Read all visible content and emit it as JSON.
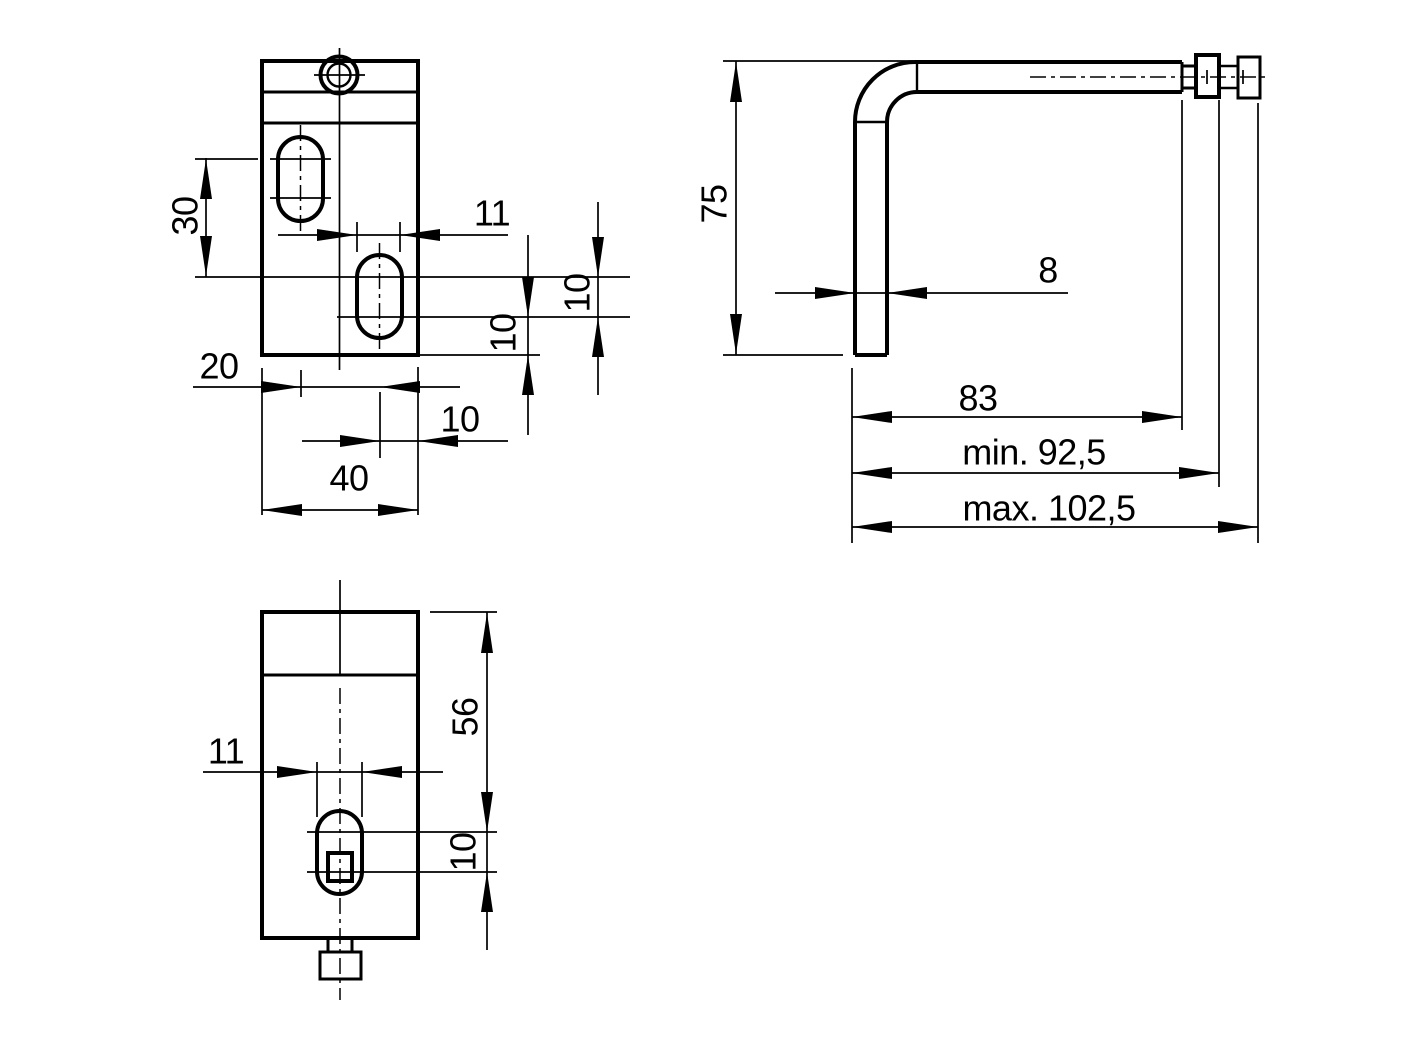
{
  "drawing": {
    "background_color": "#ffffff",
    "line_color": "#000000",
    "views": {
      "front_view": {
        "dimension_ids": [
          "front-30",
          "front-11",
          "front-10-slot-pitch",
          "front-10-edge",
          "front-20",
          "front-10-bottom",
          "front-40"
        ]
      },
      "side_view": {
        "dimension_ids": [
          "side-75",
          "side-8",
          "side-83",
          "side-min-925",
          "side-max-1025"
        ]
      },
      "bottom_view": {
        "dimension_ids": [
          "bottom-11",
          "bottom-56",
          "bottom-10"
        ]
      }
    },
    "dimensions": [
      {
        "id": "front-30",
        "label": "30",
        "x": 185,
        "y": 216,
        "rotated": true
      },
      {
        "id": "front-11",
        "label": "11",
        "x": 492,
        "y": 213,
        "rotated": false
      },
      {
        "id": "front-10-slot-pitch",
        "label": "10",
        "x": 577,
        "y": 293,
        "rotated": true
      },
      {
        "id": "front-10-edge",
        "label": "10",
        "x": 503,
        "y": 333,
        "rotated": true
      },
      {
        "id": "front-20",
        "label": "20",
        "x": 219,
        "y": 366,
        "rotated": false
      },
      {
        "id": "front-10-bottom",
        "label": "10",
        "x": 460,
        "y": 419,
        "rotated": false
      },
      {
        "id": "front-40",
        "label": "40",
        "x": 349,
        "y": 478,
        "rotated": false
      },
      {
        "id": "side-75",
        "label": "75",
        "x": 714,
        "y": 204,
        "rotated": true
      },
      {
        "id": "side-8",
        "label": "8",
        "x": 1048,
        "y": 270,
        "rotated": false
      },
      {
        "id": "side-83",
        "label": "83",
        "x": 978,
        "y": 398,
        "rotated": false
      },
      {
        "id": "side-min-925",
        "label": "min. 92,5",
        "x": 1034,
        "y": 452,
        "rotated": false
      },
      {
        "id": "side-max-1025",
        "label": "max. 102,5",
        "x": 1049,
        "y": 508,
        "rotated": false
      },
      {
        "id": "bottom-11",
        "label": "11",
        "x": 226,
        "y": 751,
        "rotated": false
      },
      {
        "id": "bottom-56",
        "label": "56",
        "x": 465,
        "y": 717,
        "rotated": true
      },
      {
        "id": "bottom-10",
        "label": "10",
        "x": 463,
        "y": 852,
        "rotated": true
      }
    ]
  }
}
